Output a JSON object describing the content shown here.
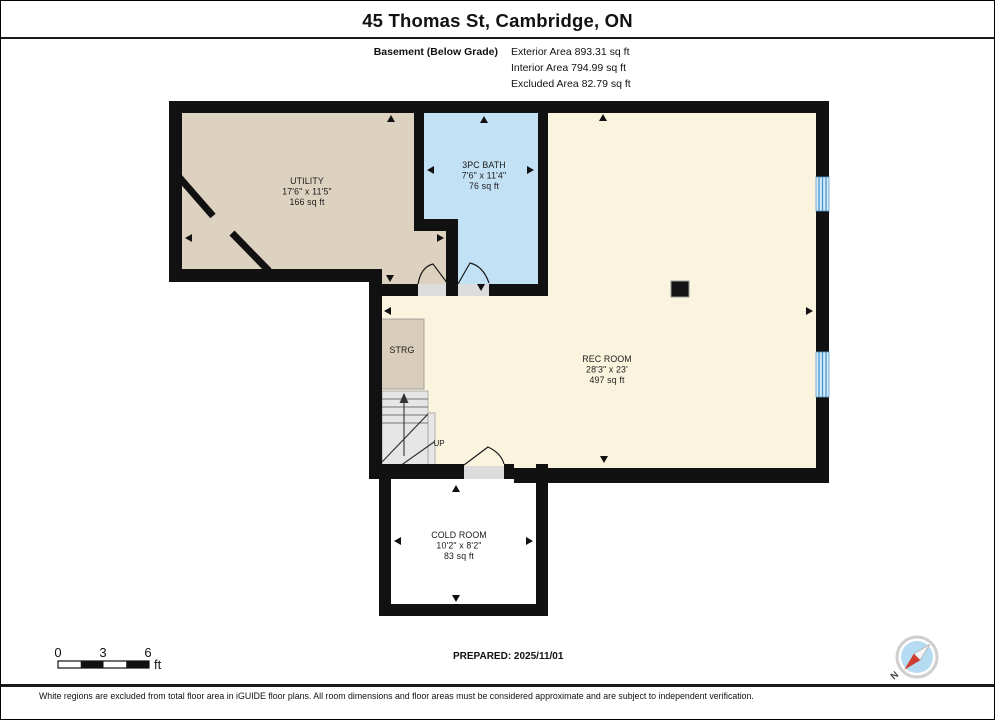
{
  "header": {
    "title": "45 Thomas St, Cambridge, ON",
    "floor_label": "Basement (Below Grade)",
    "areas": [
      "Exterior Area 893.31 sq ft",
      "Interior Area 794.99 sq ft",
      "Excluded Area 82.79 sq ft"
    ]
  },
  "rooms": {
    "utility": {
      "name": "UTILITY",
      "dims": "17'6\" x 11'5\"",
      "area": "166 sq ft"
    },
    "bath": {
      "name": "3PC BATH",
      "dims": "7'6\" x 11'4\"",
      "area": "76 sq ft"
    },
    "rec_room": {
      "name": "REC ROOM",
      "dims": "28'3\" x 23'",
      "area": "497 sq ft"
    },
    "cold_room": {
      "name": "COLD ROOM",
      "dims": "10'2\" x 8'2\"",
      "area": "83 sq ft"
    },
    "storage": {
      "name": "STRG"
    },
    "stairs": {
      "label": "UP"
    }
  },
  "scale_bar": {
    "ticks": [
      "0",
      "3",
      "6"
    ],
    "unit": "ft"
  },
  "compass": {
    "north_label": "N"
  },
  "footer": {
    "prepared": "PREPARED: 2025/11/01",
    "disclaimer": "White regions are excluded from total floor area in iGUIDE floor plans. All room dimensions and floor areas must be considered approximate and are subject to independent verification."
  },
  "colors": {
    "wall": "#111111",
    "utility_fill": "#ddd2bf",
    "bath_fill": "#c3e1f5",
    "rec_fill": "#faf3de",
    "cold_fill": "#ffffff",
    "window_accent": "#4a97cc",
    "compass_face": "#b5dcf2",
    "compass_needle": "#d23b30"
  }
}
